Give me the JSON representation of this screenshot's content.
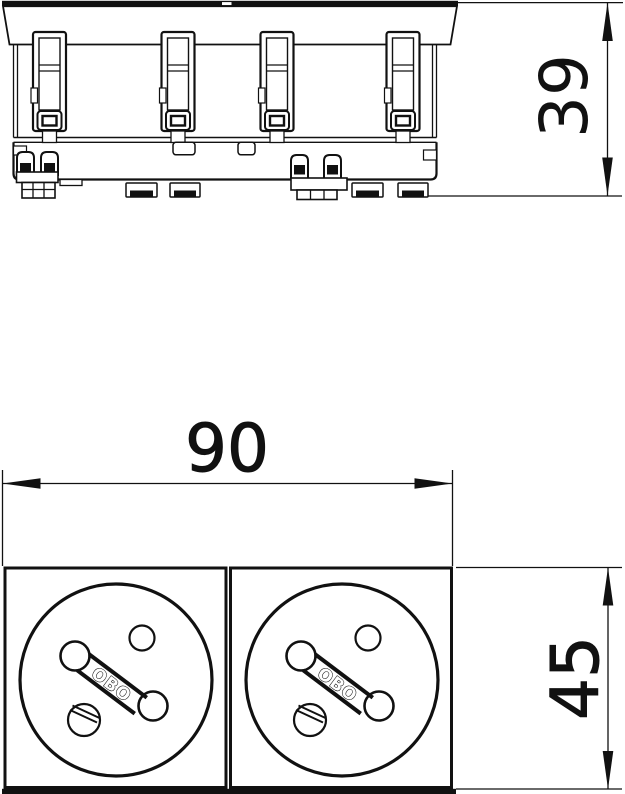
{
  "diagram": {
    "background_color": "#ffffff",
    "line_color": "#111111",
    "dimensions": {
      "side_view_height": "39",
      "front_view_width": "90",
      "front_view_height": "45"
    },
    "brand": {
      "logo_text": "OBO"
    }
  }
}
